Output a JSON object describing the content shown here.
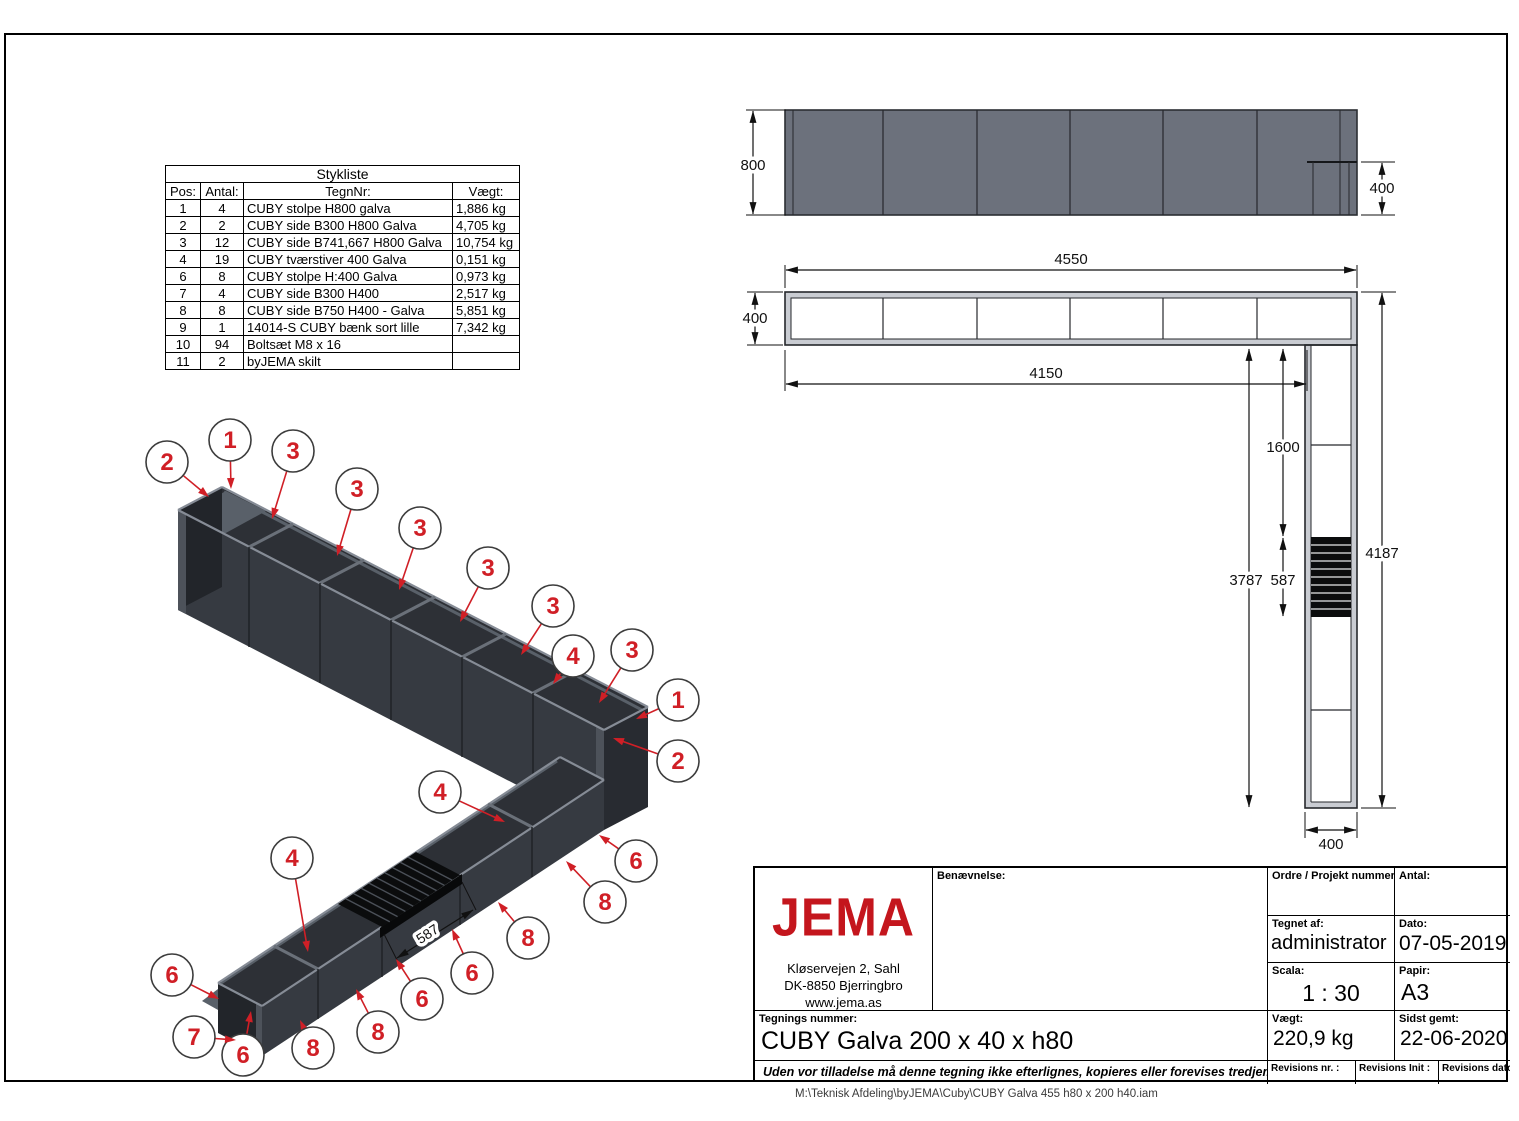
{
  "colors": {
    "accent_red": "#d01f26",
    "logo_red": "#c4161d",
    "steel_dark": "#363a41",
    "steel_gray": "#6c717c"
  },
  "parts_table": {
    "title": "Stykliste",
    "headers": [
      "Pos:",
      "Antal:",
      "TegnNr:",
      "Vægt:"
    ],
    "rows": [
      [
        "1",
        "4",
        "CUBY stolpe H800 galva",
        "1,886 kg"
      ],
      [
        "2",
        "2",
        "CUBY side B300 H800 Galva",
        "4,705 kg"
      ],
      [
        "3",
        "12",
        "CUBY side B741,667 H800 Galva",
        "10,754 kg"
      ],
      [
        "4",
        "19",
        "CUBY tværstiver 400 Galva",
        "0,151 kg"
      ],
      [
        "6",
        "8",
        "CUBY stolpe H:400 Galva",
        "0,973 kg"
      ],
      [
        "7",
        "4",
        "CUBY side B300 H400",
        "2,517 kg"
      ],
      [
        "8",
        "8",
        "CUBY side B750 H400 - Galva",
        "5,851 kg"
      ],
      [
        "9",
        "1",
        "14014-S CUBY bænk sort lille",
        "7,342 kg"
      ],
      [
        "10",
        "94",
        "Boltsæt M8 x 16",
        ""
      ],
      [
        "11",
        "2",
        "byJEMA skilt",
        ""
      ]
    ]
  },
  "title_block": {
    "logo_text": "JEMA",
    "address_lines": [
      "Kløservejen 2, Sahl",
      "DK-8850 Bjerringbro",
      "www.jema.as"
    ],
    "benaevnelse_label": "Benævnelse:",
    "ordre_label": "Ordre / Projekt nummer:",
    "antal_label": "Antal:",
    "tegnet_af_label": "Tegnet af:",
    "tegnet_af_value": "administrator",
    "dato_label": "Dato:",
    "dato_value": "07-05-2019",
    "scala_label": "Scala:",
    "scala_value": "1 : 30",
    "papir_label": "Papir:",
    "papir_value": "A3",
    "tegnings_nummer_label": "Tegnings nummer:",
    "tegnings_nummer_value": "CUBY Galva 200 x 40 x h80",
    "vaegt_label": "Vægt:",
    "vaegt_value": "220,9 kg",
    "sidst_gemt_label": "Sidst gemt:",
    "sidst_gemt_value": "22-06-2020",
    "revisions_nr_label": "Revisions nr. :",
    "revisions_init_label": "Revisions Init :",
    "revisions_dato_label": "Revisions dato :",
    "disclaimer": "Uden vor tilladelse må denne tegning ikke efterlignes, kopieres eller forevises tredjemand"
  },
  "path_note": "M:\\Teknisk Afdeling\\byJEMA\\Cuby\\CUBY Galva 455 h80 x 200 h40.iam",
  "views": {
    "elevation": {
      "dims": {
        "height": "800",
        "end_height": "400"
      }
    },
    "plan": {
      "dims": {
        "total_length": "4550",
        "width": "400",
        "inner_length": "4150",
        "to_bench": "1600",
        "leg_inner": "3787",
        "bench": "587",
        "leg_total": "4187",
        "leg_width": "400"
      }
    },
    "iso": {
      "bench_dim": "587",
      "balloons": [
        {
          "label": "2",
          "cx": 167,
          "cy": 462,
          "tx": 209,
          "ty": 497
        },
        {
          "label": "1",
          "cx": 230,
          "cy": 440,
          "tx": 231,
          "ty": 489
        },
        {
          "label": "3",
          "cx": 293,
          "cy": 451,
          "tx": 272,
          "ty": 519
        },
        {
          "label": "3",
          "cx": 357,
          "cy": 489,
          "tx": 337,
          "ty": 556
        },
        {
          "label": "3",
          "cx": 420,
          "cy": 528,
          "tx": 399,
          "ty": 590
        },
        {
          "label": "3",
          "cx": 488,
          "cy": 568,
          "tx": 460,
          "ty": 622
        },
        {
          "label": "3",
          "cx": 553,
          "cy": 606,
          "tx": 521,
          "ty": 655
        },
        {
          "label": "4",
          "cx": 573,
          "cy": 656,
          "tx": 553,
          "ty": 684
        },
        {
          "label": "3",
          "cx": 632,
          "cy": 650,
          "tx": 599,
          "ty": 703
        },
        {
          "label": "1",
          "cx": 678,
          "cy": 700,
          "tx": 636,
          "ty": 719
        },
        {
          "label": "2",
          "cx": 678,
          "cy": 761,
          "tx": 613,
          "ty": 738
        },
        {
          "label": "4",
          "cx": 440,
          "cy": 792,
          "tx": 505,
          "ty": 822
        },
        {
          "label": "6",
          "cx": 636,
          "cy": 861,
          "tx": 599,
          "ty": 835
        },
        {
          "label": "8",
          "cx": 605,
          "cy": 902,
          "tx": 566,
          "ty": 861
        },
        {
          "label": "8",
          "cx": 528,
          "cy": 938,
          "tx": 498,
          "ty": 902
        },
        {
          "label": "6",
          "cx": 472,
          "cy": 973,
          "tx": 452,
          "ty": 929
        },
        {
          "label": "6",
          "cx": 422,
          "cy": 999,
          "tx": 396,
          "ty": 959
        },
        {
          "label": "8",
          "cx": 378,
          "cy": 1032,
          "tx": 356,
          "ty": 989
        },
        {
          "label": "8",
          "cx": 313,
          "cy": 1048,
          "tx": 300,
          "ty": 1020
        },
        {
          "label": "4",
          "cx": 292,
          "cy": 858,
          "tx": 308,
          "ty": 952
        },
        {
          "label": "6",
          "cx": 243,
          "cy": 1055,
          "tx": 251,
          "ty": 1011
        },
        {
          "label": "7",
          "cx": 194,
          "cy": 1037,
          "tx": 236,
          "ty": 1040
        },
        {
          "label": "6",
          "cx": 172,
          "cy": 975,
          "tx": 219,
          "ty": 999
        }
      ]
    }
  }
}
